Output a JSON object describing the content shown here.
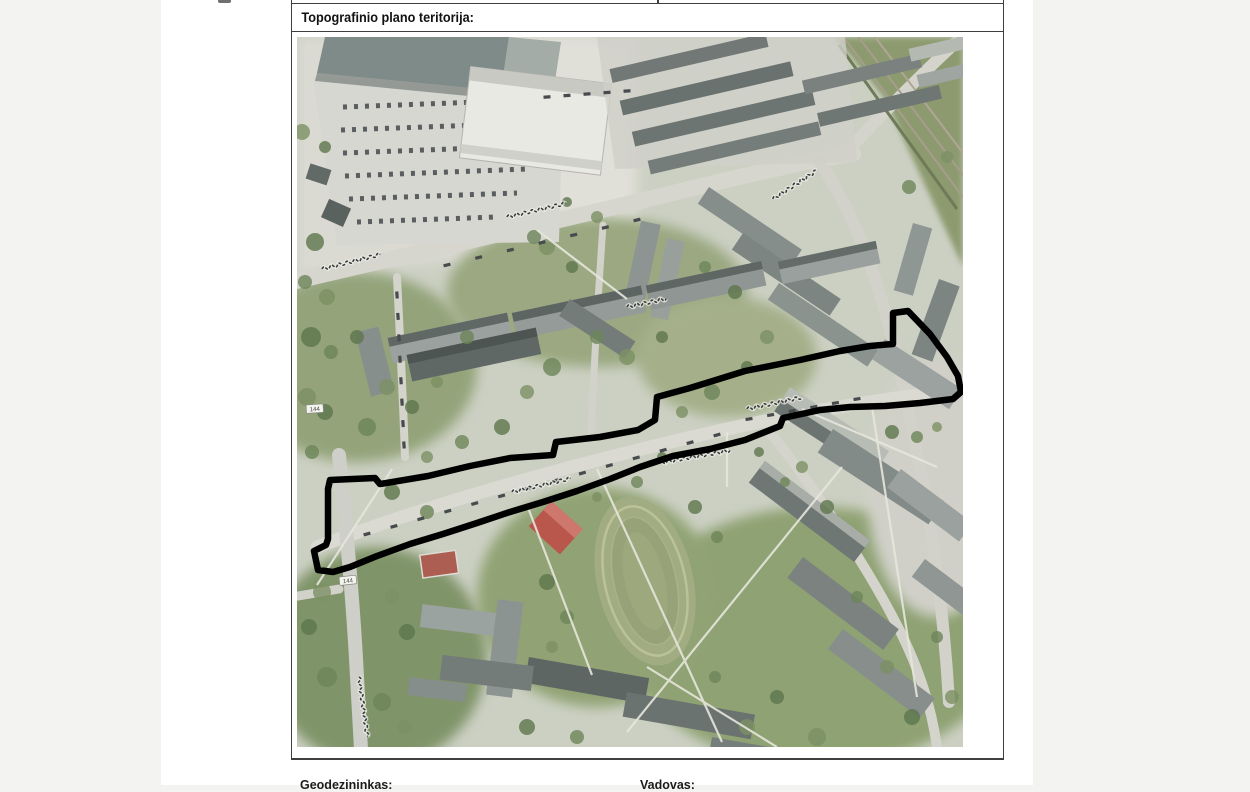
{
  "document": {
    "section_title": "Topografinio plano teritorija:",
    "footer_left_label": "Geodezininkas:",
    "footer_right_label": "Vadovas:"
  },
  "map": {
    "territory_outline": {
      "color": "#000000",
      "stroke_width": 6.5,
      "points": "33,443 78,441 83,447 131,439 173,429 213,421 256,418 259,405 303,400 341,393 358,383 360,360 393,351 448,334 503,323 543,314 573,309 596,307 596,276 611,274 633,297 650,320 661,339 664,355 656,362 623,366 588,369 553,370 523,373 486,381 483,389 448,403 413,412 376,419 343,430 313,442 280,454 246,465 213,475 180,486 146,497 113,507 80,519 53,530 36,535 21,533 17,514 29,508 31,502 31,452"
    },
    "road_badges": [
      {
        "label": "144"
      },
      {
        "label": "144"
      }
    ]
  },
  "colors": {
    "viewer_background": "#f3f3f2",
    "paper": "#ffffff",
    "table_border": "#3f3f3f",
    "map_base": "#ccd0c3"
  }
}
